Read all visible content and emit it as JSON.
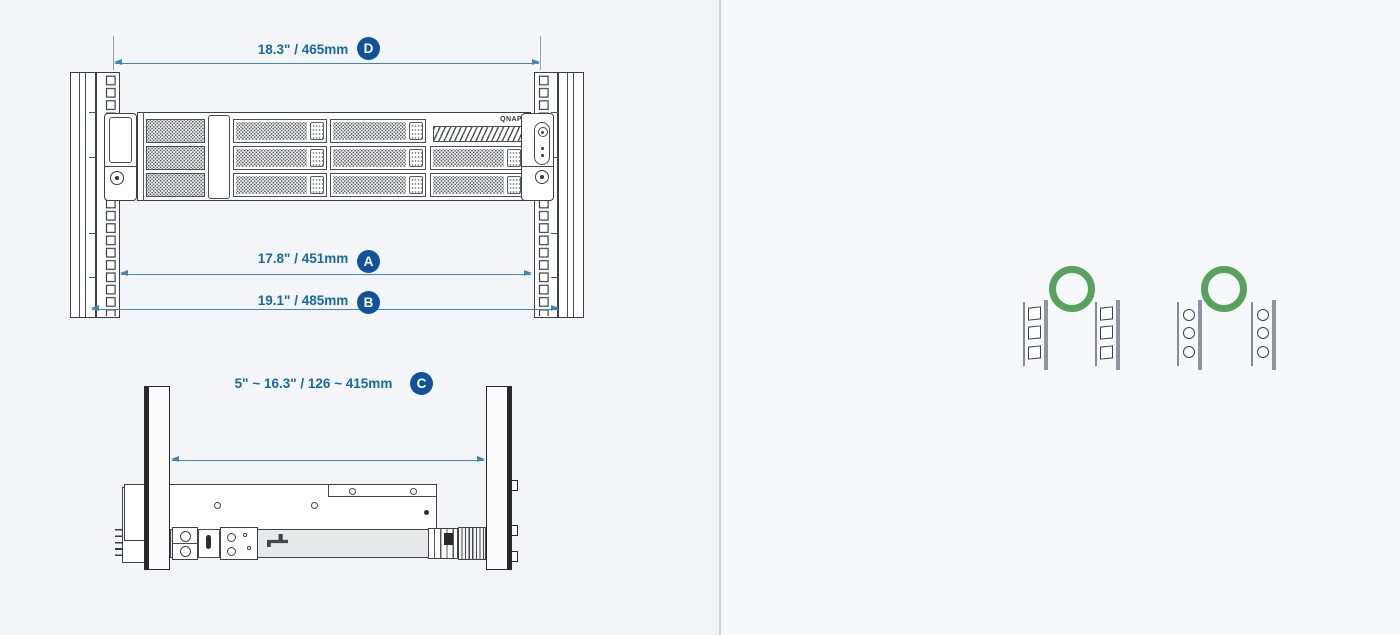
{
  "colors": {
    "dimension_text": "#1569ab",
    "badge_fill": "#0e539b",
    "arrow": "#3f87ba",
    "approved_green": "#57a25c",
    "drawing_line": "#3c4043"
  },
  "front_view": {
    "brand_logo": "QNAP",
    "dimensions": [
      {
        "badge": "D",
        "label": "18.3\" / 465mm"
      },
      {
        "badge": "A",
        "label": "17.8\" / 451mm"
      },
      {
        "badge": "B",
        "label": "19.1\" / 485mm"
      }
    ]
  },
  "side_view": {
    "dimension": {
      "badge": "C",
      "label": "5\" ~ 16.3\" / 126 ~ 415mm"
    }
  },
  "rack_hole_types": [
    {
      "type": "square-hole-posts",
      "status_icon": "green-circle-approved"
    },
    {
      "type": "round-hole-posts",
      "status_icon": "green-circle-approved"
    }
  ]
}
